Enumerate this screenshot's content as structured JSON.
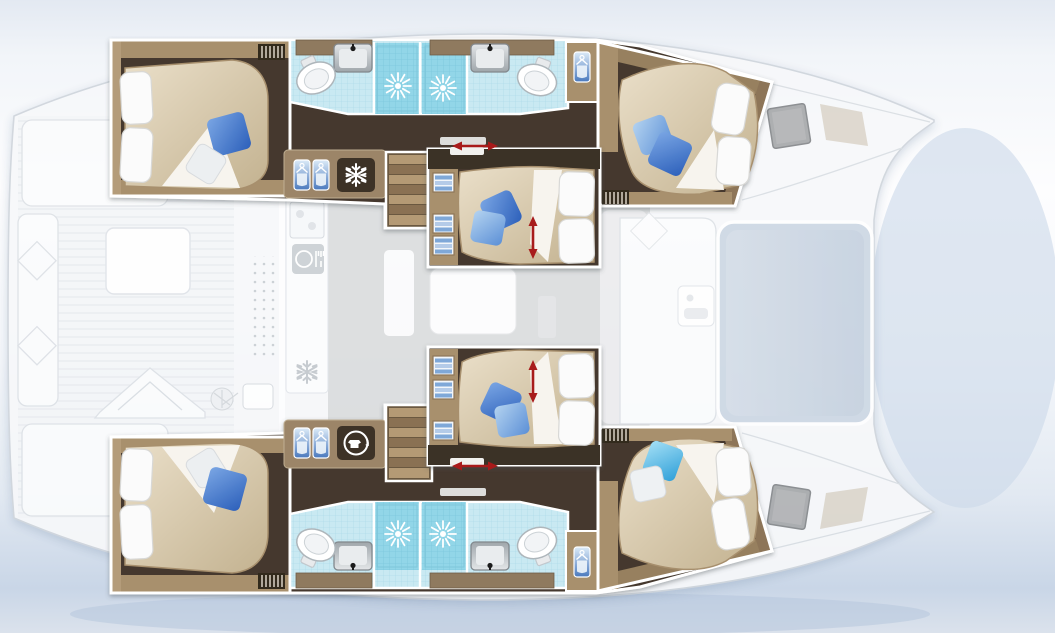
{
  "title": "Catamaran interior deck plan",
  "palette": {
    "water_top": "#e6ebf3",
    "water_bottom": "#c7d4e6",
    "hull_white": "#f7f8fa",
    "outline_gray": "#ccd2d9",
    "floor_dark": "#44392d",
    "wall_tan": "#a8906d",
    "wall_tan_dark": "#8d7558",
    "cabinet_brown": "#8f7a5e",
    "bed_light": "#eadfc9",
    "bed_dark": "#c3b290",
    "sheet_white": "#f7f4ee",
    "pillow_white": "#fafafa",
    "pillow_gray": "#eceff1",
    "pillow_blue_dark": "#2c5fba",
    "pillow_blue_light": "#5b8fd6",
    "pillow_cyan": "#2f9fd8",
    "tile_light": "#c9e9f2",
    "tile_shower": "#92d6e8",
    "fixture_gray": "#b3b9bd",
    "icon_bg_dark": "#3c3228",
    "icon_white": "#ffffff",
    "wardrobe_blue": "#4f7fc4",
    "arrow_red": "#a81a1a",
    "saloon_gray": "#d7d8da",
    "trampoline": "#cdd8e4",
    "hatch_gray": "#a7a9ab",
    "skylight_tan": "#d8d1c4"
  },
  "layout": {
    "rooms": [
      {
        "id": "top-aft-cabin",
        "kind": "double-cabin",
        "pillows": {
          "white": 2,
          "blue": 1,
          "gray": 1
        }
      },
      {
        "id": "top-bathrooms",
        "kind": "bathroom-block",
        "toilets": 2,
        "sinks": 2,
        "showers": 2
      },
      {
        "id": "top-forward-cabin",
        "kind": "double-cabin",
        "pillows": {
          "white": 2,
          "blue": 2
        }
      },
      {
        "id": "center-forward-cabin",
        "kind": "double-cabin",
        "pillows": {
          "white": 2,
          "blue": 2
        },
        "feature": "sliding-berth-arrow"
      },
      {
        "id": "center-aft-cabin",
        "kind": "double-cabin",
        "pillows": {
          "white": 2,
          "blue": 2
        },
        "feature": "sliding-berth-arrow"
      },
      {
        "id": "bottom-aft-cabin",
        "kind": "double-cabin",
        "pillows": {
          "white": 2,
          "blue": 1,
          "gray": 1
        }
      },
      {
        "id": "bottom-bathrooms",
        "kind": "bathroom-block",
        "toilets": 2,
        "sinks": 2,
        "showers": 2
      },
      {
        "id": "bottom-forward-cabin",
        "kind": "double-cabin",
        "pillows": {
          "white": 2,
          "cyan": 1,
          "gray": 1
        }
      }
    ],
    "features": {
      "staircases": 2,
      "wardrobe_hanger_icons": 6,
      "towel_cubbies": 6,
      "fridge_icons": 1,
      "washing_machine_icons": 1,
      "galley_fork_knife_icons": 1,
      "shower_head_icons": 4,
      "red_double_arrows": 4,
      "trampoline": 1,
      "bow_hatches": 2
    }
  }
}
